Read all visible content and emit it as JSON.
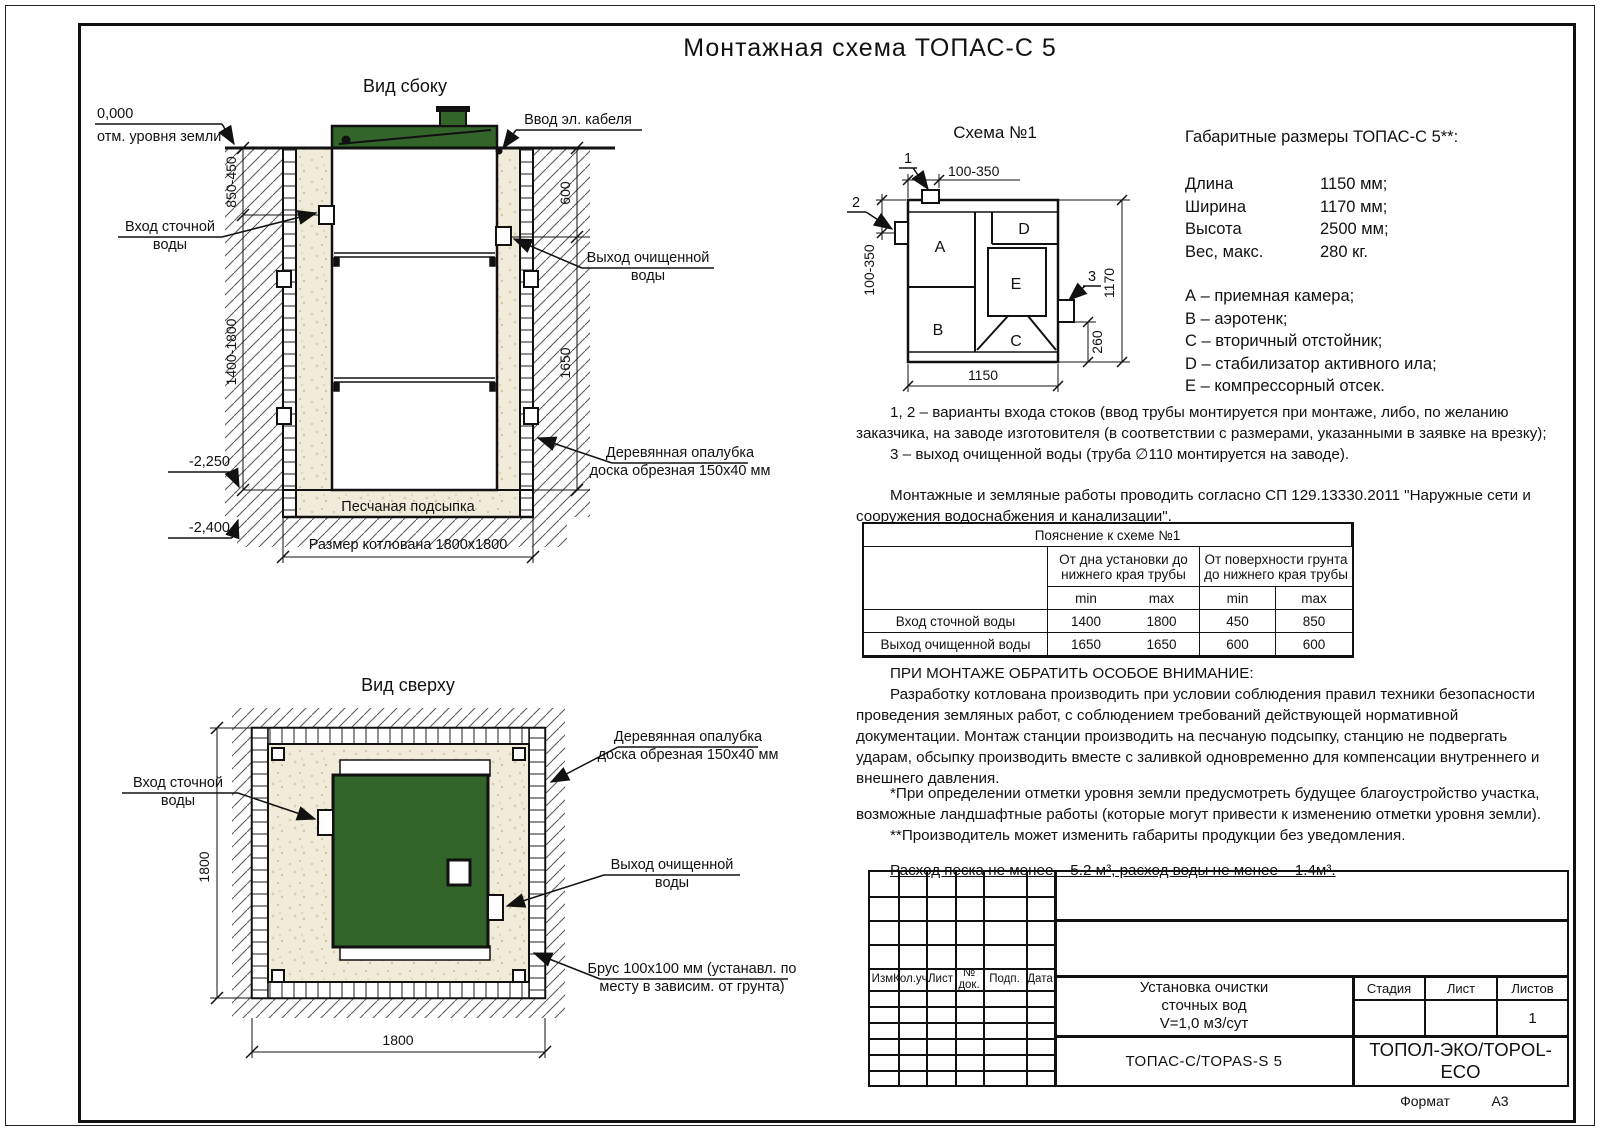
{
  "page": {
    "title": "Монтажная схема ТОПАС-С 5",
    "format_label": "Формат",
    "format_value": "А3"
  },
  "colors": {
    "green": "#33652a",
    "sand": "#f1ecda"
  },
  "side_view": {
    "title": "Вид сбоку",
    "zero_mark": "0,000",
    "ground_note": "отм. уровня земли*",
    "cable_label": "Ввод эл. кабеля",
    "inlet_l1": "Вход сточной",
    "inlet_l2": "воды",
    "outlet_l1": "Выход очищенной",
    "outlet_l2": "воды",
    "formwork_l1": "Деревянная опалубка",
    "formwork_l2": "доска обрезная 150х40 мм",
    "sand_label": "Песчаная подсыпка",
    "pit_label": "Размер котлована 1800х1800",
    "level_2250": "-2,250",
    "level_2400": "-2,400",
    "dim_depth_min": "850-450",
    "dim_depth_max": "1400-1800",
    "dim_out_depth": "600",
    "dim_out_bottom": "1650"
  },
  "top_view": {
    "title": "Вид сверху",
    "inlet_l1": "Вход сточной",
    "inlet_l2": "воды",
    "outlet_l1": "Выход очищенной",
    "outlet_l2": "воды",
    "formwork_l1": "Деревянная опалубка",
    "formwork_l2": "доска обрезная 150х40 мм",
    "beam_l1": "Брус 100х100 мм (устанавл. по",
    "beam_l2": "месту в зависим. от грунта)",
    "dim_w": "1800",
    "dim_h": "1800"
  },
  "schema1": {
    "title": "Схема №1",
    "a": "A",
    "b": "B",
    "c": "C",
    "d": "D",
    "e": "E",
    "p1": "1",
    "p2": "2",
    "p3": "3",
    "dim_top": "100-350",
    "dim_left": "100-350",
    "dim_height": "1170",
    "dim_out": "260",
    "dim_width": "1150"
  },
  "specs": {
    "heading": "Габаритные размеры ТОПАС-С 5**:",
    "rows": [
      {
        "name": "Длина",
        "value": "1150 мм;"
      },
      {
        "name": "Ширина",
        "value": "1170 мм;"
      },
      {
        "name": "Высота",
        "value": "2500 мм;"
      },
      {
        "name": "Вес, макс.",
        "value": "280 кг."
      }
    ],
    "legend": [
      "А – приемная камера;",
      "В – аэротенк;",
      "С – вторичный отстойник;",
      "D – стабилизатор активного ила;",
      "Е – компрессорный отсек."
    ]
  },
  "notes": {
    "p1": "1, 2 – варианты входа стоков (ввод трубы монтируется при монтаже, либо, по желанию заказчика, на заводе изготовителя (в соответствии с размерами, указанными в заявке на врезку);",
    "p2": "3 – выход очищенной воды (труба ∅110 монтируется на заводе).",
    "p3": "Монтажные и земляные работы проводить согласно СП 129.13330.2011 \"Наружные сети и сооружения водоснабжения и канализации\"."
  },
  "table": {
    "title": "Пояснение к схеме №1",
    "col1": "От дна установки до нижнего края трубы",
    "col2": "От поверхности грунта до нижнего края трубы",
    "min1": "min",
    "max1": "max",
    "min2": "min",
    "max2": "max",
    "rows": [
      {
        "name": "Вход сточной воды",
        "v1": "1400",
        "v2": "1800",
        "v3": "450",
        "v4": "850"
      },
      {
        "name": "Выход очищенной воды",
        "v1": "1650",
        "v2": "1650",
        "v3": "600",
        "v4": "600"
      }
    ]
  },
  "attention": {
    "heading": "ПРИ МОНТАЖЕ ОБРАТИТЬ ОСОБОЕ ВНИМАНИЕ:",
    "body": "Разработку котлована производить при условии соблюдения правил техники безопасности проведения земляных работ, с соблюдением требований действующей нормативной документации. Монтаж станции производить на песчаную подсыпку, станцию не подвергать ударам, обсыпку производить вместе с заливкой одновременно для компенсации внутреннего и внешнего давления.",
    "foot1": "*При определении отметки уровня земли предусмотреть будущее благоустройство участка, возможные ландшафтные работы (которые могут привести к изменению отметки уровня земли).",
    "foot2": "**Производитель может изменить габариты продукции без уведомления.",
    "consumption": "Расход песка не менее – 5.2 м³, расход воды не менее – 1.4м³."
  },
  "title_block": {
    "rev_headers": [
      "Изм.",
      "Кол.уч.",
      "Лист",
      "№ док.",
      "Подп.",
      "Дата"
    ],
    "doc_l1": "Установка очистки",
    "doc_l2": "сточных вод",
    "doc_l3": "V=1,0 м3/сут",
    "stage": "Стадия",
    "sheet": "Лист",
    "sheets": "Листов",
    "sheets_value": "1",
    "model": "ТОПАС-С/TOPAS-S 5",
    "company": "ТОПОЛ-ЭКО/TOPOL-ECO"
  }
}
